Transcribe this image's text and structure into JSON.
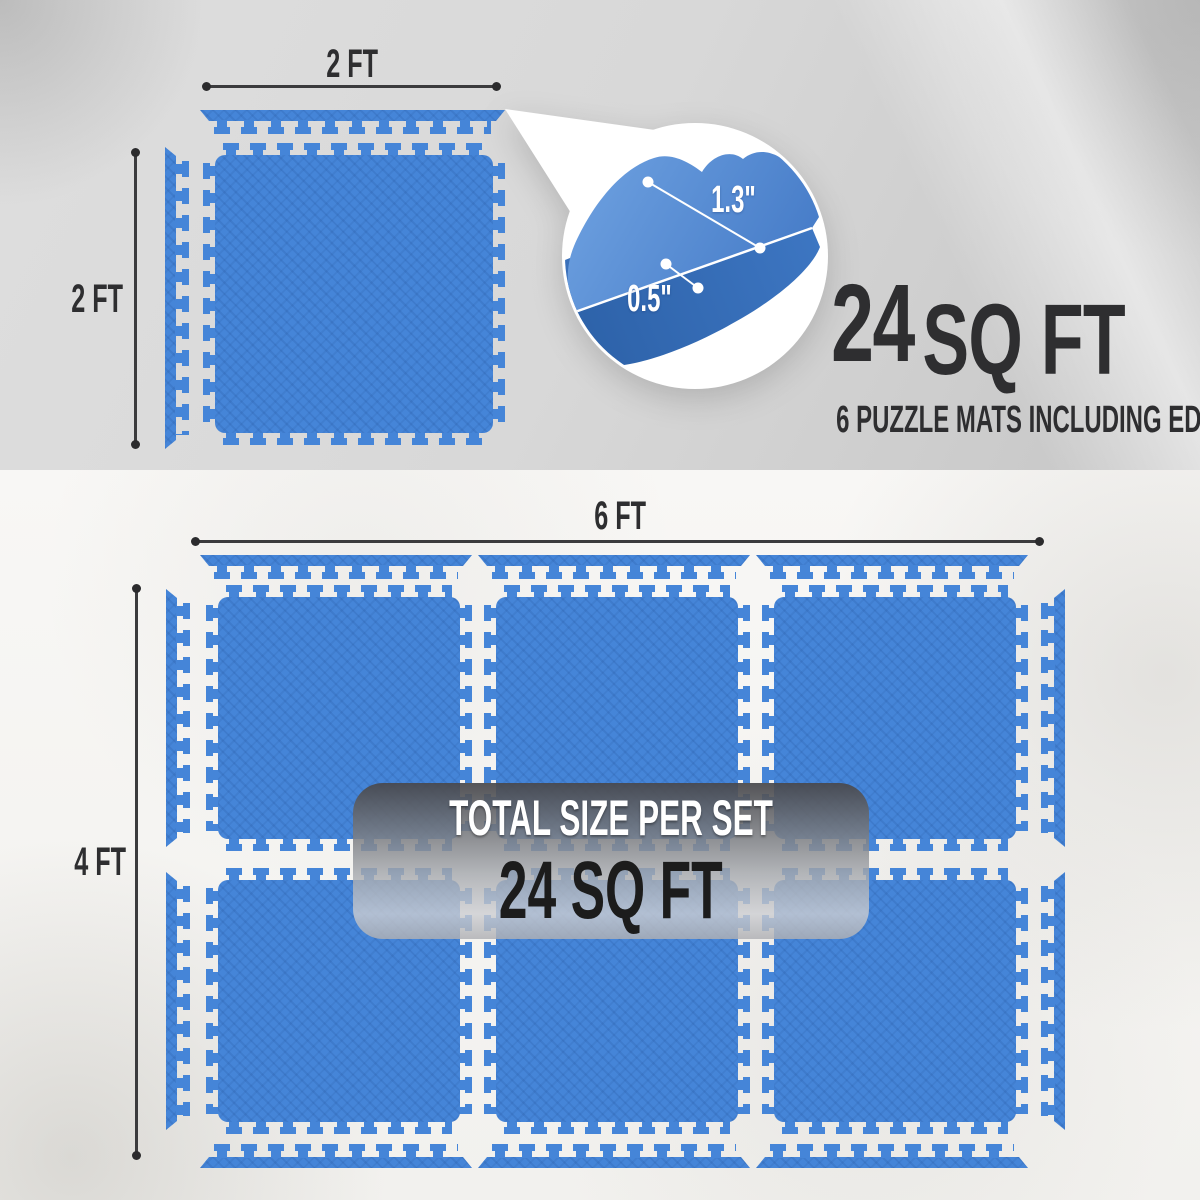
{
  "colors": {
    "mat_blue": "#4585d8",
    "accent_text": "#2e2e30",
    "badge_value_color": "#1c1c1c"
  },
  "top_panel": {
    "mat_width_label": "2 FT",
    "mat_height_label": "2 FT",
    "inset": {
      "interlock_depth": "1.3\"",
      "mat_thickness": "0.5\""
    },
    "coverage_value": "24",
    "coverage_unit": "SQ FT",
    "coverage_note": "6 PUZZLE MATS INCLUDING EDGE PIECES"
  },
  "bottom_panel": {
    "set_width_label": "6 FT",
    "set_height_label": "4 FT",
    "badge_title": "TOTAL SIZE PER SET",
    "badge_value": "24 SQ FT"
  }
}
